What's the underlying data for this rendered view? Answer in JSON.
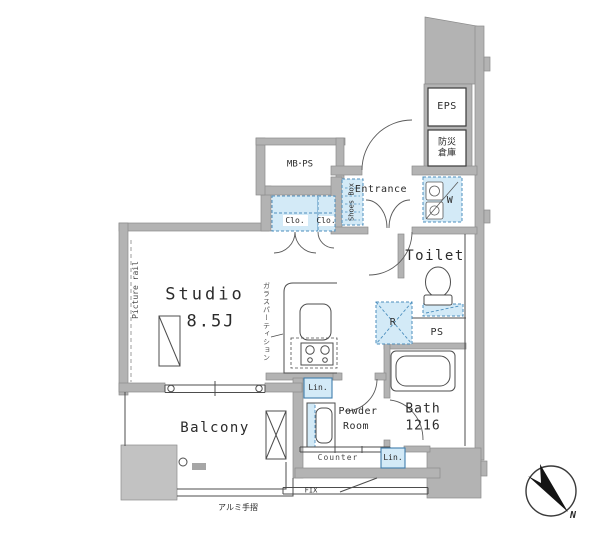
{
  "colors": {
    "wall_fill": "#b3b3b3",
    "wall_edge": "#8c8c8c",
    "line": "#4d4d4d",
    "closet_fill": "#d3eaf7",
    "closet_border": "#4d8fbe",
    "label_text": "#2b2b2b",
    "compass_black": "#141414"
  },
  "rooms": {
    "studio": {
      "label": "Studio",
      "size": "8.5J"
    },
    "balcony": {
      "label": "Balcony"
    },
    "entrance": {
      "label": "Entrance"
    },
    "toilet": {
      "label": "Toilet"
    },
    "bath": {
      "label": "Bath",
      "size": "1216"
    },
    "powder_room": {
      "label_line1": "Powder",
      "label_line2": "Room"
    },
    "meter_box_pipe_space": {
      "label": "MB･PS"
    },
    "eps_shaft": {
      "label": "EPS"
    },
    "disaster_storage": {
      "label_line1": "防災",
      "label_line2": "倉庫"
    }
  },
  "features": {
    "closet_left": "Clo.",
    "closet_right": "Clo.",
    "shoes_box": "Shoes Box",
    "washing_machine": "W",
    "refrigerator": "R",
    "pipe_space": "PS",
    "linen_upper": "Lin.",
    "linen_lower": "Lin.",
    "counter": "Counter",
    "picture_rail": "Picture rail",
    "glass_partition": "ガラスパーティション",
    "aluminum_handrail": "アルミ手摺",
    "fixed_window": "FIX"
  },
  "compass": {
    "north_label": "N"
  }
}
